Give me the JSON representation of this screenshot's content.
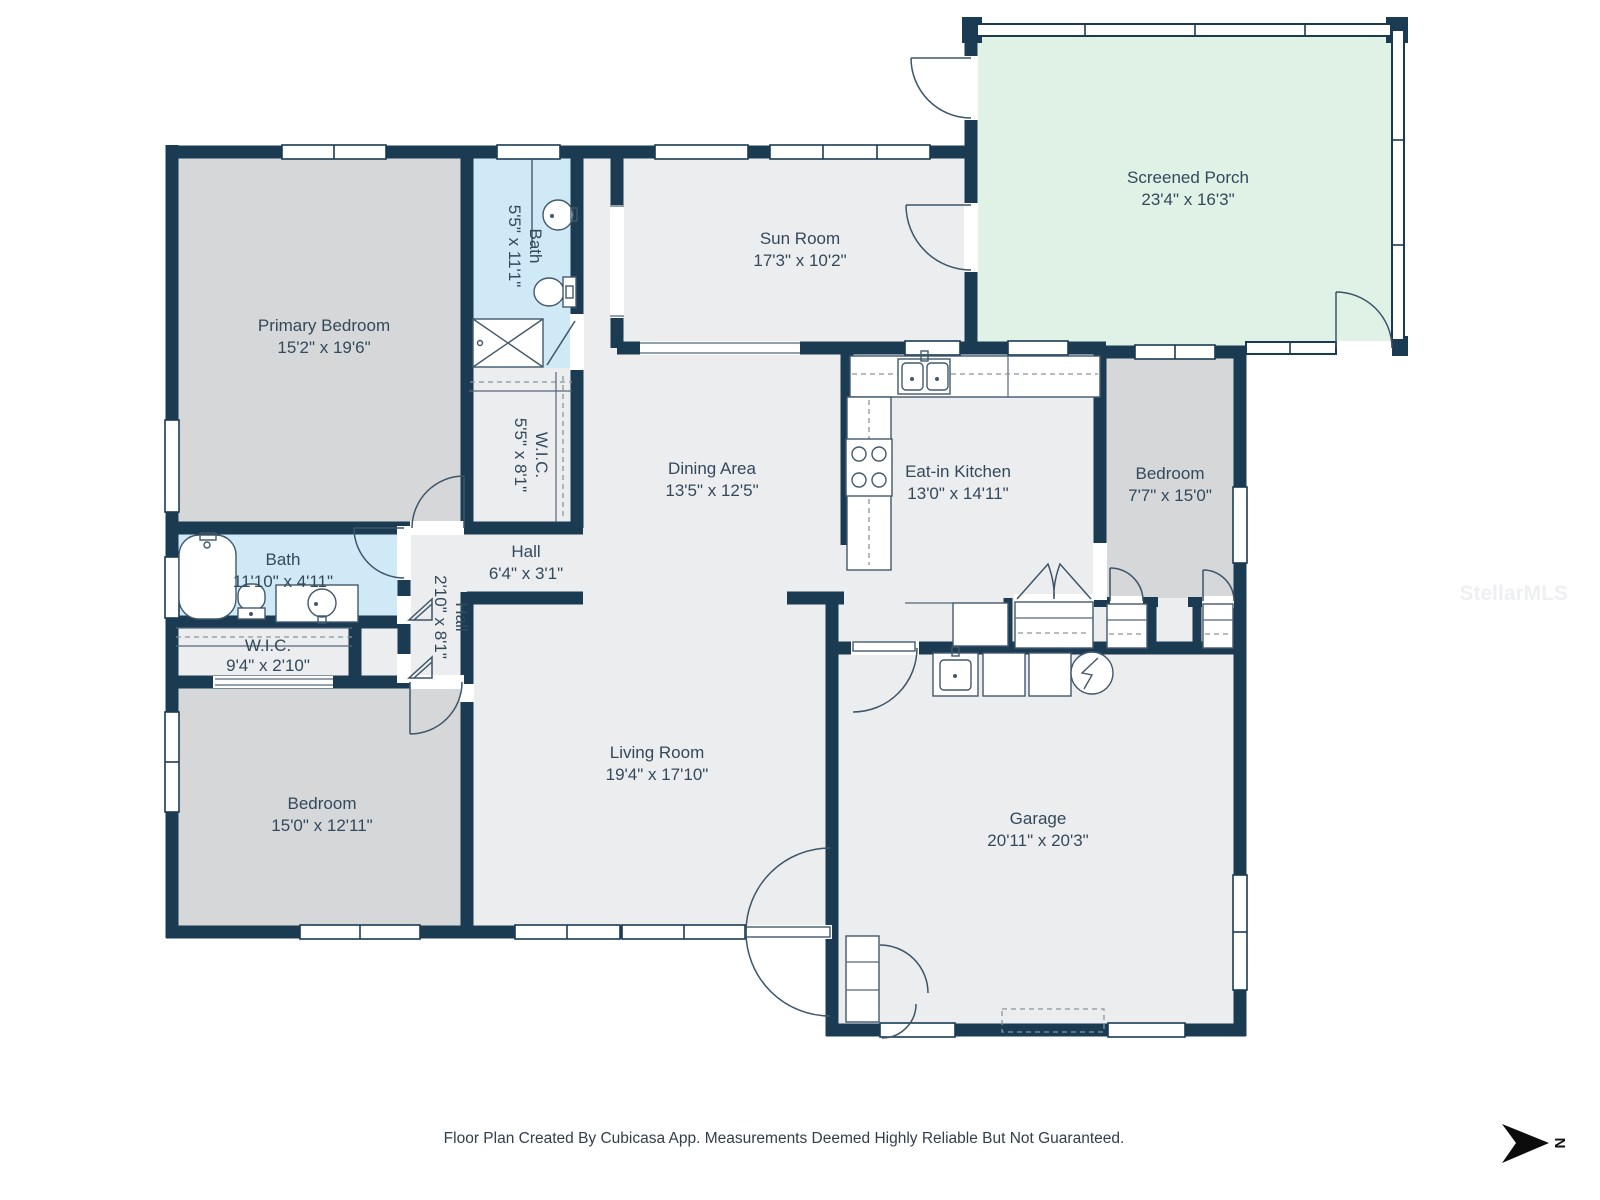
{
  "plan": {
    "footer": "Floor Plan Created By Cubicasa App. Measurements Deemed Highly Reliable But Not Guaranteed.",
    "watermark": "StellarMLS",
    "north_label": "N"
  },
  "colors": {
    "wall": "#1b3b53",
    "room_light": "#ecedee",
    "room_bedroom": "#d5d7d9",
    "room_bath": "#cfe9f7",
    "room_porch": "#e0f1e6",
    "label_text": "#33495c"
  },
  "rooms": [
    {
      "id": "primary-bedroom",
      "name": "Primary Bedroom",
      "dims": "15'2\" x 19'6\""
    },
    {
      "id": "bath-primary",
      "name": "Bath",
      "dims": "5'5\" x 11'1\""
    },
    {
      "id": "wic-primary",
      "name": "W.I.C.",
      "dims": "5'5\" x 8'1\""
    },
    {
      "id": "sun-room",
      "name": "Sun Room",
      "dims": "17'3\" x 10'2\""
    },
    {
      "id": "screened-porch",
      "name": "Screened Porch",
      "dims": "23'4\" x 16'3\""
    },
    {
      "id": "dining-area",
      "name": "Dining Area",
      "dims": "13'5\" x 12'5\""
    },
    {
      "id": "eat-in-kitchen",
      "name": "Eat-in Kitchen",
      "dims": "13'0\" x 14'11\""
    },
    {
      "id": "bedroom-right",
      "name": "Bedroom",
      "dims": "7'7\" x 15'0\""
    },
    {
      "id": "bath-hall",
      "name": "Bath",
      "dims": "11'10\" x 4'11\""
    },
    {
      "id": "hall",
      "name": "Hall",
      "dims": "6'4\" x 3'1\""
    },
    {
      "id": "hall-2",
      "name": "Hall",
      "dims": "2'10\" x 8'1\""
    },
    {
      "id": "wic-hall",
      "name": "W.I.C.",
      "dims": "9'4\" x 2'10\""
    },
    {
      "id": "bedroom-left",
      "name": "Bedroom",
      "dims": "15'0\" x 12'11\""
    },
    {
      "id": "living-room",
      "name": "Living Room",
      "dims": "19'4\" x 17'10\""
    },
    {
      "id": "garage",
      "name": "Garage",
      "dims": "20'11\" x 20'3\""
    }
  ]
}
